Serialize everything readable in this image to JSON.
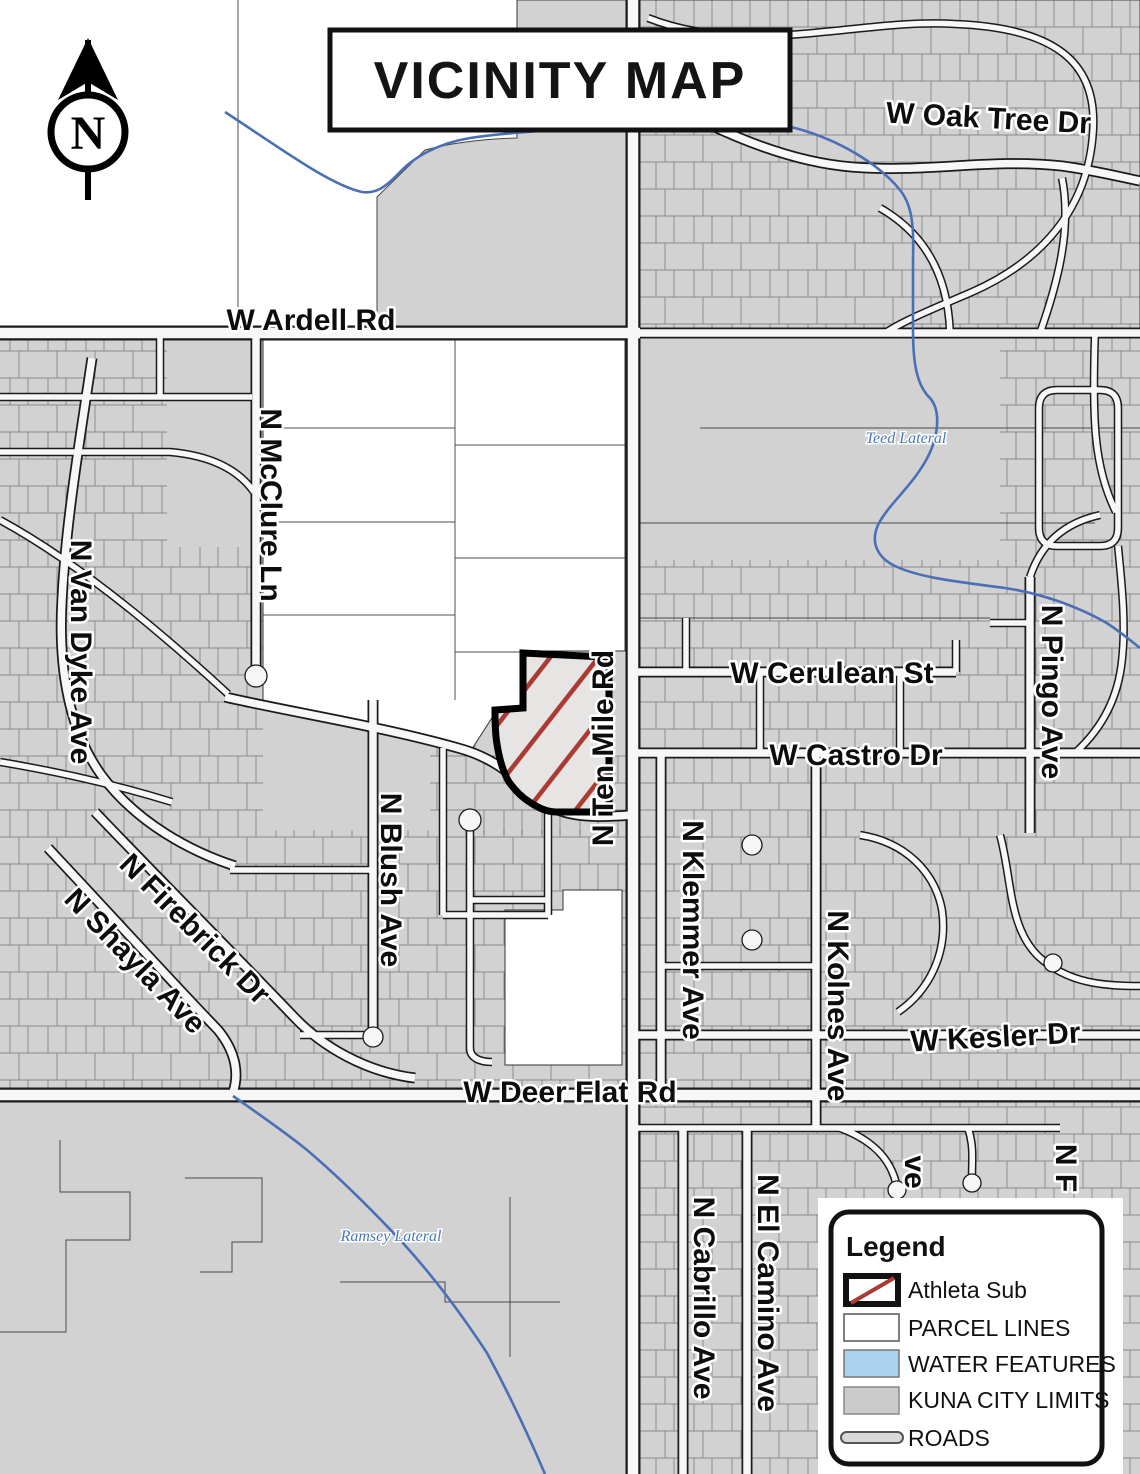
{
  "title": "VICINITY MAP",
  "north": {
    "letter": "N"
  },
  "legend": {
    "title": "Legend",
    "items": [
      {
        "label": "Athleta Sub"
      },
      {
        "label": "PARCEL LINES"
      },
      {
        "label": "WATER FEATURES"
      },
      {
        "label": "KUNA CITY LIMITS"
      },
      {
        "label": "ROADS"
      }
    ]
  },
  "streets": {
    "oak_tree": "W Oak Tree Dr",
    "ardell": "W Ardell Rd",
    "mcclure": "N McClure Ln",
    "van_dyke": "N Van Dyke Ave",
    "ten_mile": "N Ten Mile Rd",
    "cerulean": "W Cerulean St",
    "castro": "W Castro Dr",
    "pingo": "N Pingo Ave",
    "klemmer": "N Klemmer Ave",
    "kolnes": "N Kolnes Ave",
    "kesler": "W Kesler Dr",
    "deer_flat": "W Deer Flat Rd",
    "blush": "N Blush Ave",
    "firebrick": "N Firebrick Dr",
    "shayla": "N Shayla Ave",
    "cabrillo": "N Cabrillo Ave",
    "el_camino": "N El Camino Ave",
    "partial_ave": "ve",
    "partial_nf": "N F"
  },
  "water": {
    "teed": "Teed Lateral",
    "ramsey": "Ramsey Lateral"
  },
  "colors": {
    "city_limits": "#d2d2d2",
    "water": "#4a6fb5",
    "water_fill": "#a9d2ee",
    "subject_hatch": "#a93a34",
    "parcel_fill": "#e6e5e3"
  }
}
